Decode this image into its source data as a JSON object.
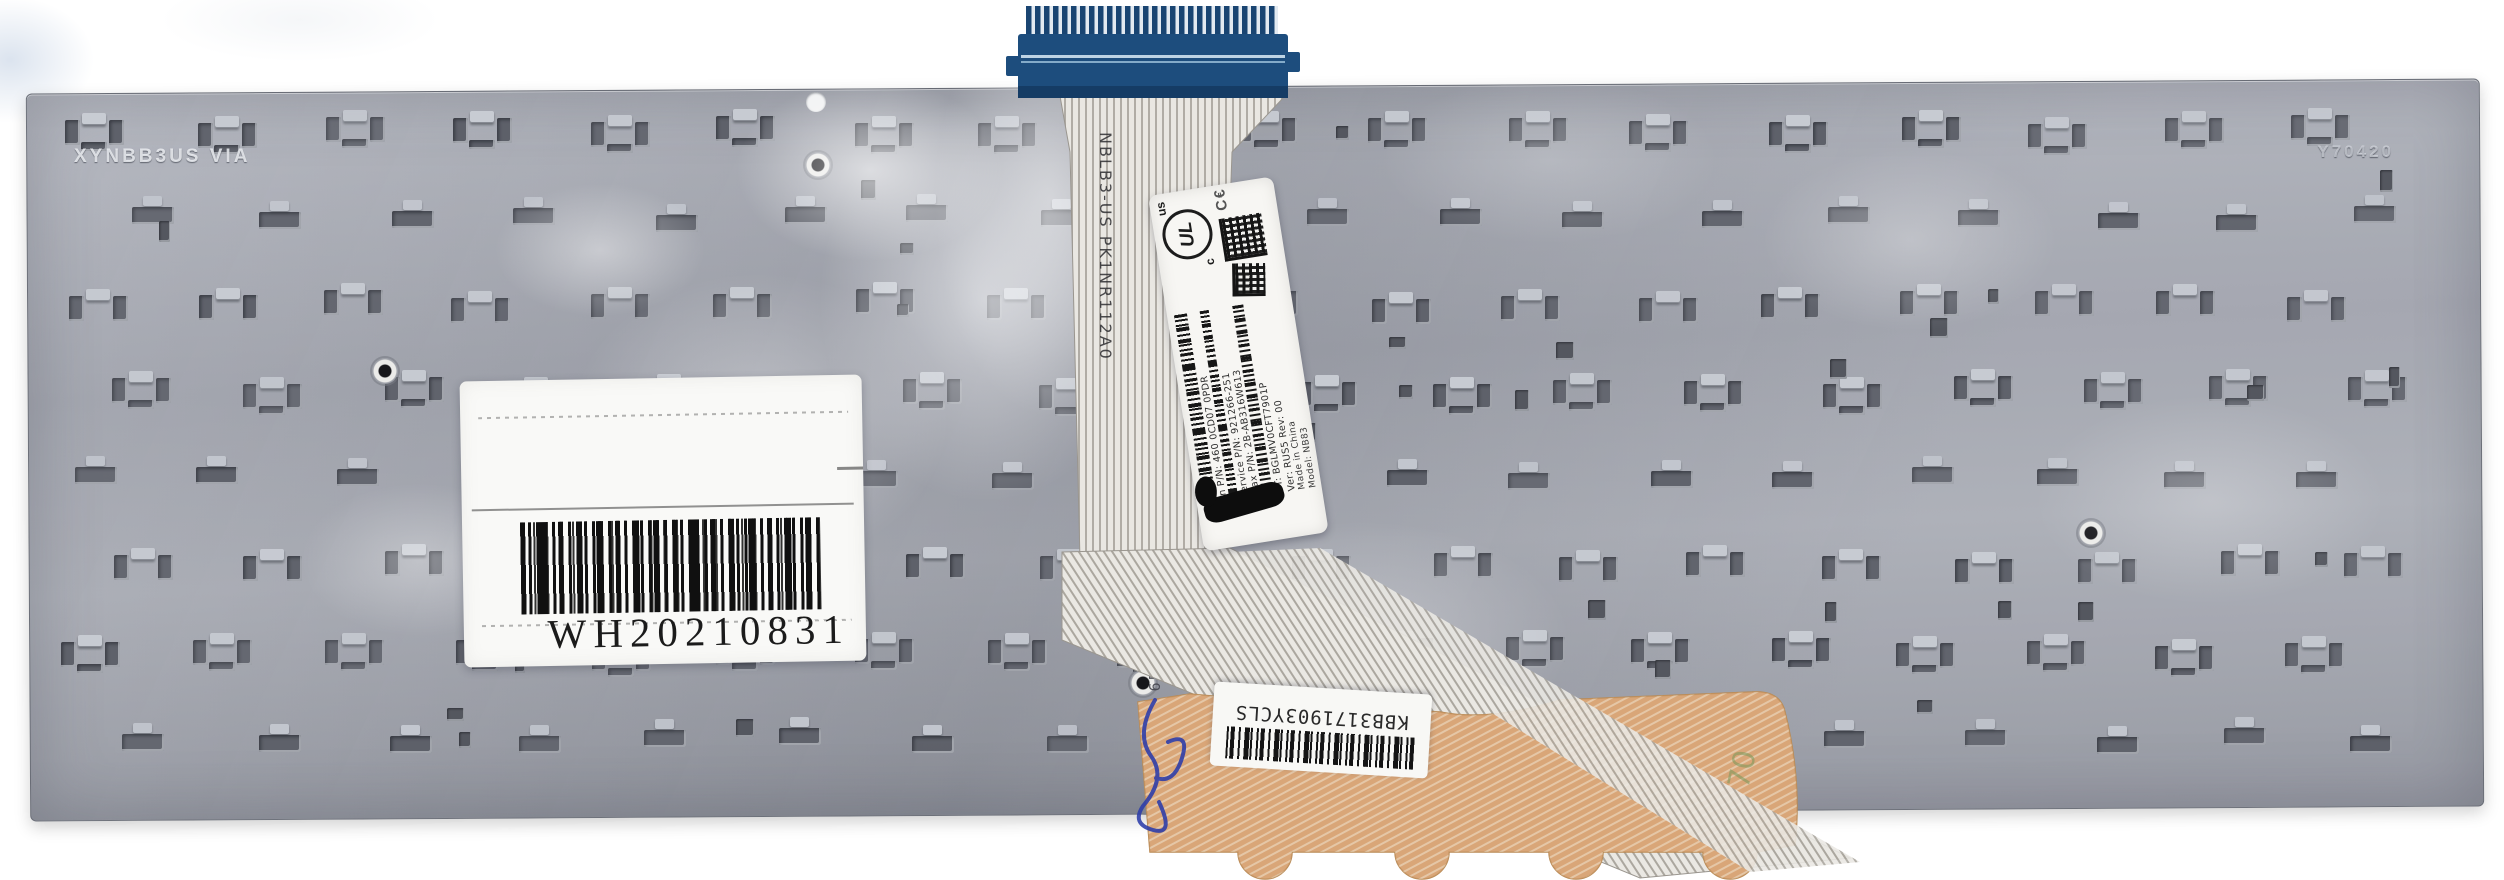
{
  "scene": {
    "description": "Rear view of a silver laptop keyboard metal backplate with ribbon cable, blue connector and labels"
  },
  "colors": {
    "plate_base": "#a4a7b0",
    "hole_dark": "#5c5f68",
    "tab_highlight": "#c9cdd4",
    "connector_blue": "#1d4d7d",
    "ribbon_base": "#e9e7e2",
    "tail_orange": "#d9a678",
    "label_white": "#f7f6f3",
    "barcode_black": "#141414",
    "ink_blue": "#2b3caa"
  },
  "etched": {
    "top_left": "XYNBB3US VIA",
    "top_right": "Y70420",
    "serial_vertical": "6560000004990"
  },
  "ribbon": {
    "flex_marking": "NBLB3-US PK1NR112A0"
  },
  "ribbon_label": {
    "ul_prefix": "c",
    "ul": "UL",
    "ul_suffix": "us",
    "ce": "C€",
    "lines": [
      "an P/N: 460 0CD07 0PDR",
      "Service P/N: 921266-251",
      "max P/N: 2B-AB316W613",
      "CT: BGLMV0CFT7901P",
      "Ver: RUS5  Rev: 00"
    ],
    "origin_lines": [
      "Made in China",
      "Model: NB83"
    ]
  },
  "warranty_sticker": {
    "code": "WH20210831"
  },
  "bottom_label": {
    "code": "KBB3171903YCLS"
  },
  "handwriting": {
    "green_note": "70"
  }
}
